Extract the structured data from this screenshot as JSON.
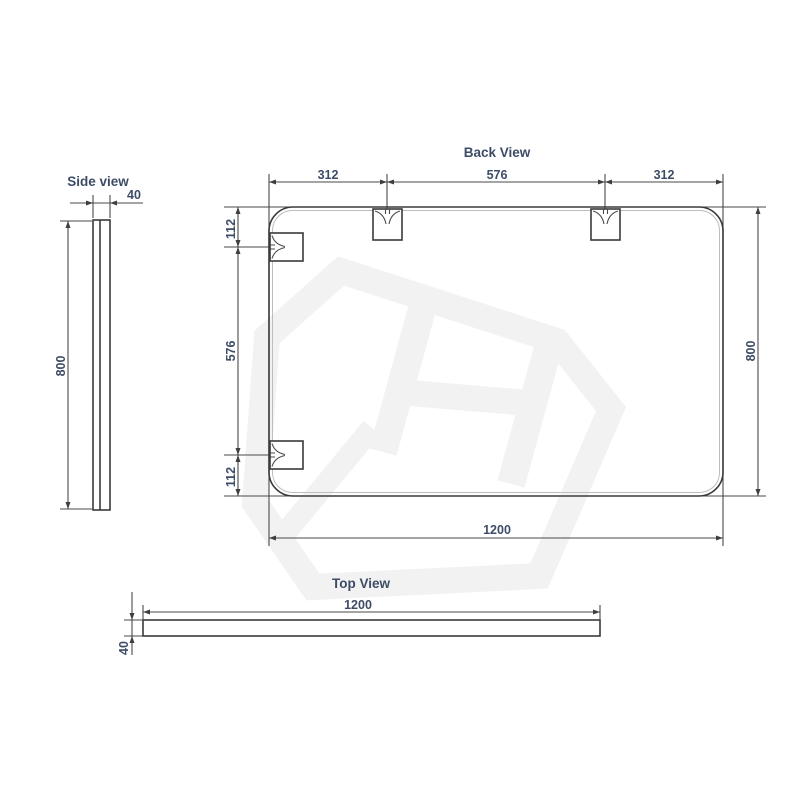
{
  "drawing": {
    "back_view": {
      "title": "Back View",
      "top_segments": [
        "312",
        "576",
        "312"
      ],
      "left_segments": [
        "112",
        "576",
        "112"
      ],
      "height_label": "800",
      "width_label": "1200"
    },
    "side_view": {
      "title": "Side view",
      "thickness_label": "40",
      "height_label": "800"
    },
    "top_view": {
      "title": "Top View",
      "width_label": "1200",
      "thickness_label": "40"
    },
    "colors": {
      "object_line": "#3a3a3a",
      "dimension_line": "#4a4a4a",
      "dimension_text": "#3d4c66",
      "watermark": "#f2f2f2",
      "background": "#ffffff"
    }
  }
}
